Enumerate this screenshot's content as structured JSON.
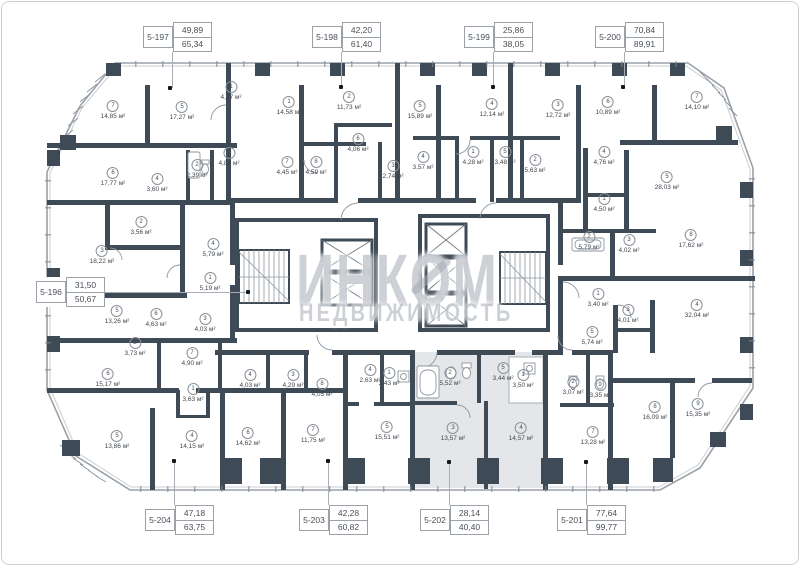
{
  "plan": {
    "watermark": {
      "line1": "ИНКОМ",
      "line2": "НЕДВИЖИМОСТЬ"
    },
    "area_unit": "м²",
    "colors": {
      "wall": "#3e4a55",
      "highlight_fill": "#e4e6e9",
      "thin_line": "#8f979f",
      "watermark": "rgba(164,171,180,0.55)",
      "leader": "#a8aeb5"
    },
    "icons": [
      "elevator-x-icon",
      "stair-treads-icon",
      "bathtub-icon",
      "sink-icon",
      "toilet-icon",
      "washer-icon"
    ],
    "units": [
      {
        "id": "5-197",
        "area_living": "49,89",
        "area_total": "65,34",
        "side": "top",
        "bx": 143,
        "by": 22,
        "lx": 172,
        "dx": 170,
        "dy": 88
      },
      {
        "id": "5-198",
        "area_living": "42,20",
        "area_total": "61,40",
        "side": "top",
        "bx": 312,
        "by": 22,
        "lx": 341,
        "dx": 341,
        "dy": 87
      },
      {
        "id": "5-199",
        "area_living": "25,86",
        "area_total": "38,05",
        "side": "top",
        "bx": 464,
        "by": 22,
        "lx": 493,
        "dx": 493,
        "dy": 87
      },
      {
        "id": "5-200",
        "area_living": "70,84",
        "area_total": "89,91",
        "side": "top",
        "bx": 595,
        "by": 22,
        "lx": 624,
        "dx": 623,
        "dy": 87
      },
      {
        "id": "5-196",
        "area_living": "31,50",
        "area_total": "50,67",
        "side": "left",
        "bx": 36,
        "by": 277,
        "ly": 292,
        "dx": 248,
        "dy": 292
      },
      {
        "id": "5-204",
        "area_living": "47,18",
        "area_total": "63,75",
        "side": "bottom",
        "bx": 145,
        "by": 505,
        "lx": 174,
        "dx": 174,
        "dy": 461
      },
      {
        "id": "5-203",
        "area_living": "42,28",
        "area_total": "60,82",
        "side": "bottom",
        "bx": 299,
        "by": 505,
        "lx": 328,
        "dx": 328,
        "dy": 461
      },
      {
        "id": "5-202",
        "area_living": "28,14",
        "area_total": "40,40",
        "side": "bottom",
        "bx": 420,
        "by": 505,
        "lx": 449,
        "dx": 449,
        "dy": 462,
        "highlighted": true
      },
      {
        "id": "5-201",
        "area_living": "77,64",
        "area_total": "99,77",
        "side": "bottom",
        "bx": 557,
        "by": 505,
        "lx": 586,
        "dx": 586,
        "dy": 462
      }
    ],
    "rooms": [
      {
        "n": "7",
        "area": "14,85 м²",
        "x": 113,
        "y": 110
      },
      {
        "n": "5",
        "area": "17,27 м²",
        "x": 182,
        "y": 111
      },
      {
        "n": "1",
        "area": "4,57 м²",
        "x": 231,
        "y": 91
      },
      {
        "n": "6",
        "area": "17,77 м²",
        "x": 113,
        "y": 177
      },
      {
        "n": "2",
        "area": "2,39 м²",
        "x": 197,
        "y": 169
      },
      {
        "n": "3",
        "area": "4,84 м²",
        "x": 229,
        "y": 157
      },
      {
        "n": "4",
        "area": "3,60 м²",
        "x": 157,
        "y": 183
      },
      {
        "n": "1",
        "area": "14,58 м²",
        "x": 289,
        "y": 106
      },
      {
        "n": "2",
        "area": "11,73 м²",
        "x": 349,
        "y": 101
      },
      {
        "n": "6",
        "area": "4,06 м²",
        "x": 358,
        "y": 143
      },
      {
        "n": "7",
        "area": "4,45 м²",
        "x": 287,
        "y": 166
      },
      {
        "n": "8",
        "area": "4,59 м²",
        "x": 316,
        "y": 166
      },
      {
        "n": "3",
        "area": "2,74 м²",
        "x": 393,
        "y": 170
      },
      {
        "n": "5",
        "area": "15,89 м²",
        "x": 420,
        "y": 110
      },
      {
        "n": "4",
        "area": "3,57 м²",
        "x": 423,
        "y": 161
      },
      {
        "n": "1",
        "area": "4,28 м²",
        "x": 473,
        "y": 156
      },
      {
        "n": "4",
        "area": "12,14 м²",
        "x": 492,
        "y": 108
      },
      {
        "n": "5",
        "area": "3,48 м²",
        "x": 505,
        "y": 156
      },
      {
        "n": "2",
        "area": "5,63 м²",
        "x": 535,
        "y": 164
      },
      {
        "n": "3",
        "area": "12,72 м²",
        "x": 558,
        "y": 109
      },
      {
        "n": "6",
        "area": "10,89 м²",
        "x": 608,
        "y": 106
      },
      {
        "n": "7",
        "area": "14,10 м²",
        "x": 697,
        "y": 101
      },
      {
        "n": "4",
        "area": "4,76 м²",
        "x": 604,
        "y": 156
      },
      {
        "n": "5",
        "area": "28,03 м²",
        "x": 667,
        "y": 181
      },
      {
        "n": "1",
        "area": "4,50 м²",
        "x": 604,
        "y": 203
      },
      {
        "n": "2",
        "area": "5,79 м²",
        "x": 589,
        "y": 241
      },
      {
        "n": "3",
        "area": "4,02 м²",
        "x": 629,
        "y": 244
      },
      {
        "n": "8",
        "area": "17,62 м²",
        "x": 691,
        "y": 239
      },
      {
        "n": "1",
        "area": "3,40 м²",
        "x": 598,
        "y": 298
      },
      {
        "n": "3",
        "area": "4,01 м²",
        "x": 628,
        "y": 314
      },
      {
        "n": "4",
        "area": "32,04 м²",
        "x": 697,
        "y": 309
      },
      {
        "n": "5",
        "area": "5,74 м²",
        "x": 592,
        "y": 336
      },
      {
        "n": "2",
        "area": "3,07 м²",
        "x": 573,
        "y": 386
      },
      {
        "n": "9",
        "area": "3,35 м²",
        "x": 600,
        "y": 389
      },
      {
        "n": "8",
        "area": "16,09 м²",
        "x": 655,
        "y": 411
      },
      {
        "n": "9",
        "area": "15,35 м²",
        "x": 698,
        "y": 408
      },
      {
        "n": "7",
        "area": "13,28 м²",
        "x": 593,
        "y": 436
      },
      {
        "n": "2",
        "area": "5,52 м²",
        "x": 450,
        "y": 377
      },
      {
        "n": "5",
        "area": "3,44 м²",
        "x": 503,
        "y": 372
      },
      {
        "n": "1",
        "area": "3,50 м²",
        "x": 523,
        "y": 379
      },
      {
        "n": "3",
        "area": "13,57 м²",
        "x": 453,
        "y": 432
      },
      {
        "n": "4",
        "area": "14,57 м²",
        "x": 521,
        "y": 432
      },
      {
        "n": "4",
        "area": "2,63 м²",
        "x": 370,
        "y": 374
      },
      {
        "n": "1",
        "area": "3,43 м²",
        "x": 389,
        "y": 377
      },
      {
        "n": "5",
        "area": "15,51 м²",
        "x": 387,
        "y": 431
      },
      {
        "n": "6",
        "area": "14,62 м²",
        "x": 248,
        "y": 437
      },
      {
        "n": "7",
        "area": "11,75 м²",
        "x": 313,
        "y": 434
      },
      {
        "n": "4",
        "area": "4,03 м²",
        "x": 250,
        "y": 379
      },
      {
        "n": "3",
        "area": "4,29 м²",
        "x": 293,
        "y": 379
      },
      {
        "n": "8",
        "area": "4,05 м²",
        "x": 322,
        "y": 388
      },
      {
        "n": "2",
        "area": "3,56 м²",
        "x": 141,
        "y": 226
      },
      {
        "n": "3",
        "area": "18,22 м²",
        "x": 102,
        "y": 255
      },
      {
        "n": "4",
        "area": "5,79 м²",
        "x": 213,
        "y": 248
      },
      {
        "n": "1",
        "area": "5,19 м²",
        "x": 210,
        "y": 282
      },
      {
        "n": "5",
        "area": "13,26 м²",
        "x": 117,
        "y": 315
      },
      {
        "n": "6",
        "area": "4,63 м²",
        "x": 156,
        "y": 318
      },
      {
        "n": "3",
        "area": "4,03 м²",
        "x": 205,
        "y": 323
      },
      {
        "n": "2",
        "area": "3,73 м²",
        "x": 135,
        "y": 347
      },
      {
        "n": "7",
        "area": "4,90 м²",
        "x": 192,
        "y": 357
      },
      {
        "n": "6",
        "area": "15,17 м²",
        "x": 108,
        "y": 378
      },
      {
        "n": "1",
        "area": "3,63 м²",
        "x": 193,
        "y": 393
      },
      {
        "n": "5",
        "area": "13,86 м²",
        "x": 117,
        "y": 440
      },
      {
        "n": "4",
        "area": "14,15 м²",
        "x": 192,
        "y": 440
      }
    ]
  }
}
